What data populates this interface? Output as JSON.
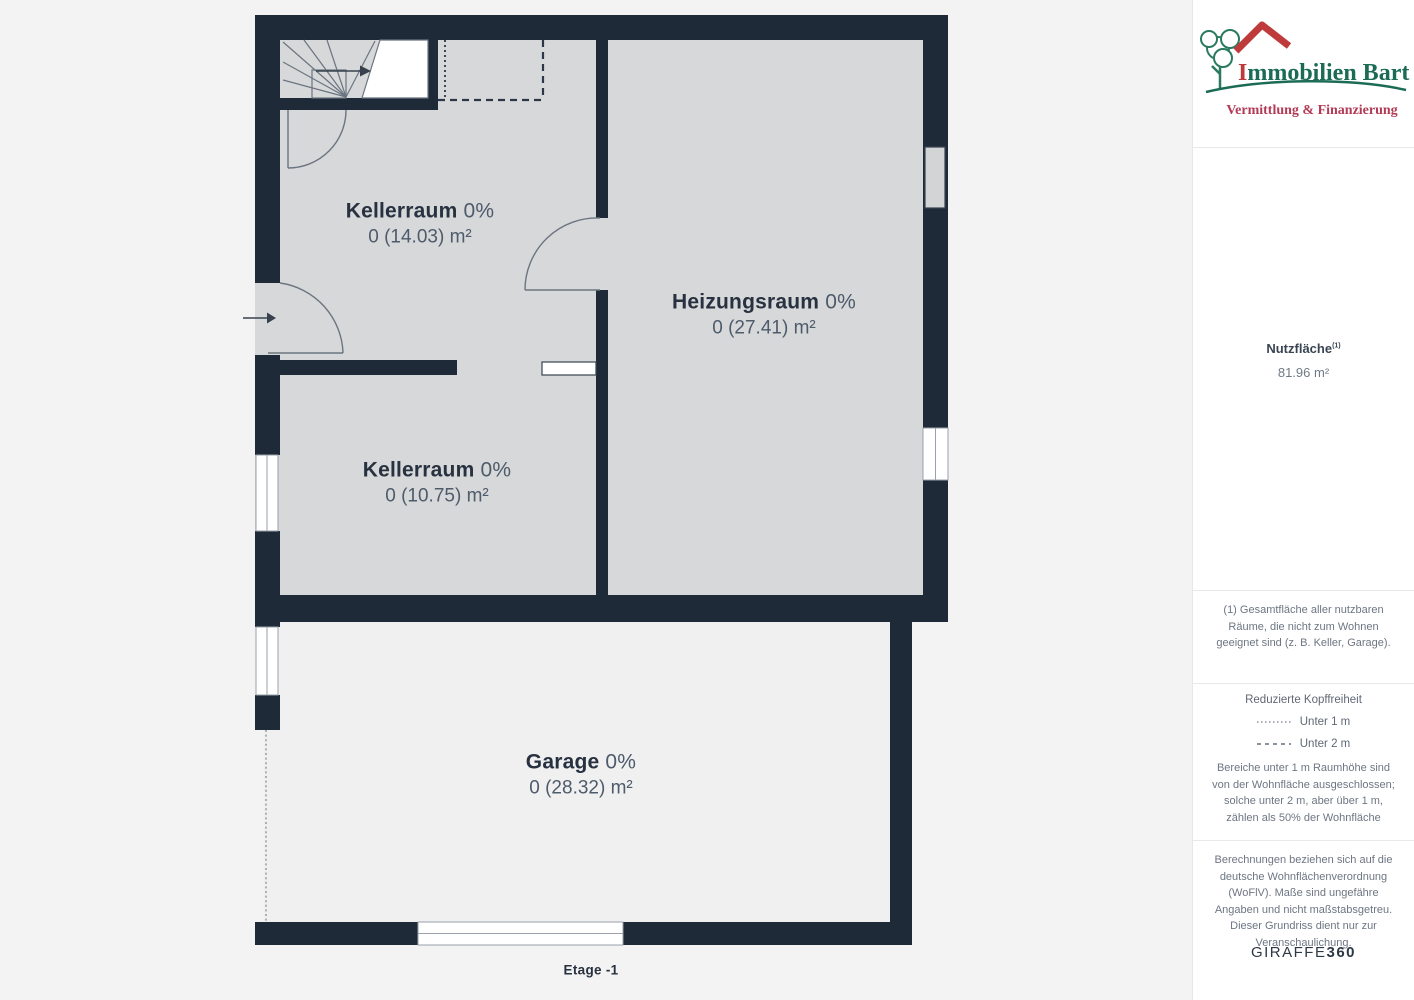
{
  "floorplan": {
    "floor_label": "Etage -1",
    "rooms": [
      {
        "name": "Kellerraum",
        "percent": "0%",
        "value": "0 (14.03) m²"
      },
      {
        "name": "Heizungsraum",
        "percent": "0%",
        "value": "0 (27.41) m²"
      },
      {
        "name": "Kellerraum",
        "percent": "0%",
        "value": "0 (10.75) m²"
      },
      {
        "name": "Garage",
        "percent": "0%",
        "value": "0 (28.32) m²"
      }
    ],
    "colors": {
      "wall": "#1f2a39",
      "room_fill": "#d7d8da",
      "garage_fill": "#f0f0f1",
      "label_text": "#27313f",
      "label_muted": "#4e5b6b"
    }
  },
  "sidebar": {
    "logo": {
      "title_initial": "I",
      "title_rest": "mmobilien Bart",
      "subtitle": "Vermittlung & Finanzierung",
      "title_color": "#1c6b55",
      "subtitle_color": "#b23a55",
      "roof_color": "#bf3a3a"
    },
    "area": {
      "label": "Nutzfläche",
      "superscript": "(1)",
      "value": "81.96 m²"
    },
    "footnote": "(1) Gesamtfläche aller nutzbaren Räume, die nicht zum Wohnen geeignet sind (z. B. Keller, Garage).",
    "legend": {
      "title": "Reduzierte Kopffreiheit",
      "items": [
        {
          "style": "dotted",
          "label": "Unter 1 m"
        },
        {
          "style": "dashed",
          "label": "Unter 2 m"
        }
      ],
      "note": "Bereiche unter 1 m Raumhöhe sind von der Wohnfläche ausgeschlossen; solche unter 2 m, aber über 1 m, zählen als 50% der Wohnfläche"
    },
    "disclaimer": "Berechnungen beziehen sich auf die deutsche Wohnflächenverordnung (WoFlV). Maße sind ungefähre Angaben und nicht maßstabsgetreu. Dieser Grundriss dient nur zur Veranschaulichung.",
    "brand": {
      "name": "GIRAFFE",
      "suffix": "360"
    }
  }
}
